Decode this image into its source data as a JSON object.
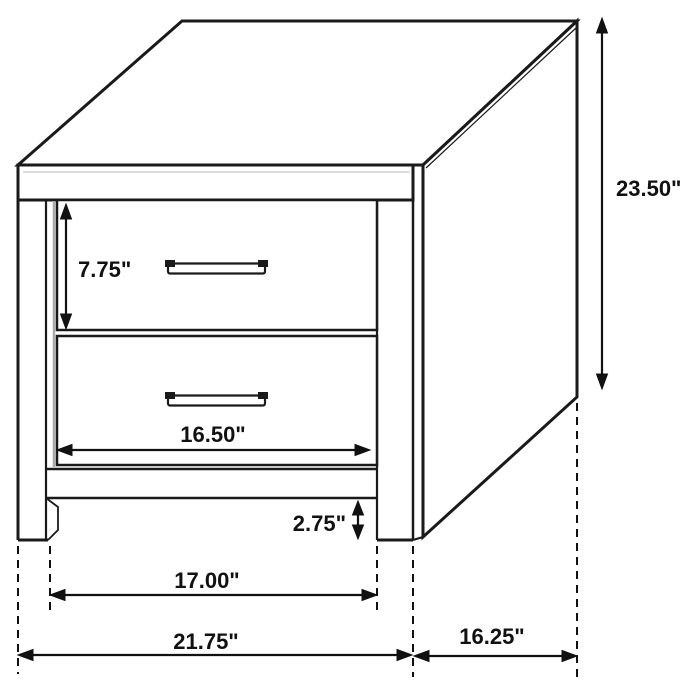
{
  "figure": {
    "kind": "furniture-dimension-line-drawing",
    "subject": "two-drawer nightstand",
    "unit": "inches"
  },
  "colors": {
    "line": "#1a1a1a",
    "background": "#ffffff",
    "shade": "#aaaaaa",
    "text": "#111111"
  },
  "dimensions": [
    {
      "id": "drawer-height",
      "label": "7.75\"",
      "orientation": "vertical"
    },
    {
      "id": "overall-height",
      "label": "23.50\"",
      "orientation": "vertical"
    },
    {
      "id": "drawer-width",
      "label": "16.50\"",
      "orientation": "horizontal"
    },
    {
      "id": "leg-clearance",
      "label": "2.75\"",
      "orientation": "vertical"
    },
    {
      "id": "leg-span",
      "label": "17.00\"",
      "orientation": "horizontal"
    },
    {
      "id": "overall-width",
      "label": "21.75\"",
      "orientation": "horizontal"
    },
    {
      "id": "overall-depth",
      "label": "16.25\"",
      "orientation": "horizontal"
    }
  ]
}
